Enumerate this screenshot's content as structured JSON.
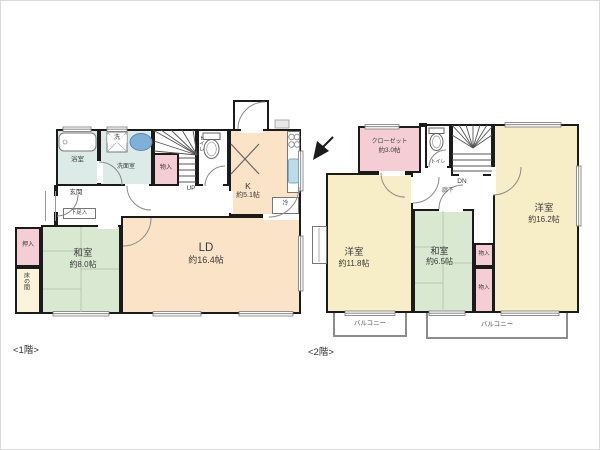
{
  "floor1": {
    "caption": "<1階>",
    "washitsu": {
      "name": "和室",
      "size": "約8.0帖"
    },
    "ld": {
      "name": "LD",
      "size": "約16.4帖"
    },
    "kitchen": {
      "name": "K",
      "size": "約5.1帖"
    },
    "bath": "浴室",
    "laundry": "洗",
    "senmen": "洗面室",
    "monoire": "物入",
    "toilet": "トイレ",
    "stairs": "UP",
    "genkan": "玄関",
    "getabako": "下足入",
    "oshiire": "押入",
    "tokonoma": "床の間",
    "fridge": "冷"
  },
  "floor2": {
    "caption": "<2階>",
    "closet": {
      "name": "クローゼット",
      "size": "約3.0帖"
    },
    "yoshitsu_left": {
      "name": "洋室",
      "size": "約11.8帖"
    },
    "washitsu": {
      "name": "和室",
      "size": "約6.5帖"
    },
    "yoshitsu_right": {
      "name": "洋室",
      "size": "約16.2帖"
    },
    "monoire_top": "物入",
    "monoire_bottom": "物入",
    "hallway": "廊下",
    "stairs": "DN",
    "toilet": "トイレ",
    "balcony_left": "バルコニー",
    "balcony_right": "バルコニー"
  },
  "colors": {
    "wall": "#1b1b1b",
    "tatami_green": "#d9e8d0",
    "wood_peach": "#fbe3c7",
    "room_yellow": "#f7eec7",
    "closet_pink": "#f4ced4",
    "tokonoma_cream": "#fbf3da",
    "wet_area_teal": "#dcebe8",
    "sink_blue": "#7fb0d8",
    "balcony_gray": "#8d8d8d"
  }
}
